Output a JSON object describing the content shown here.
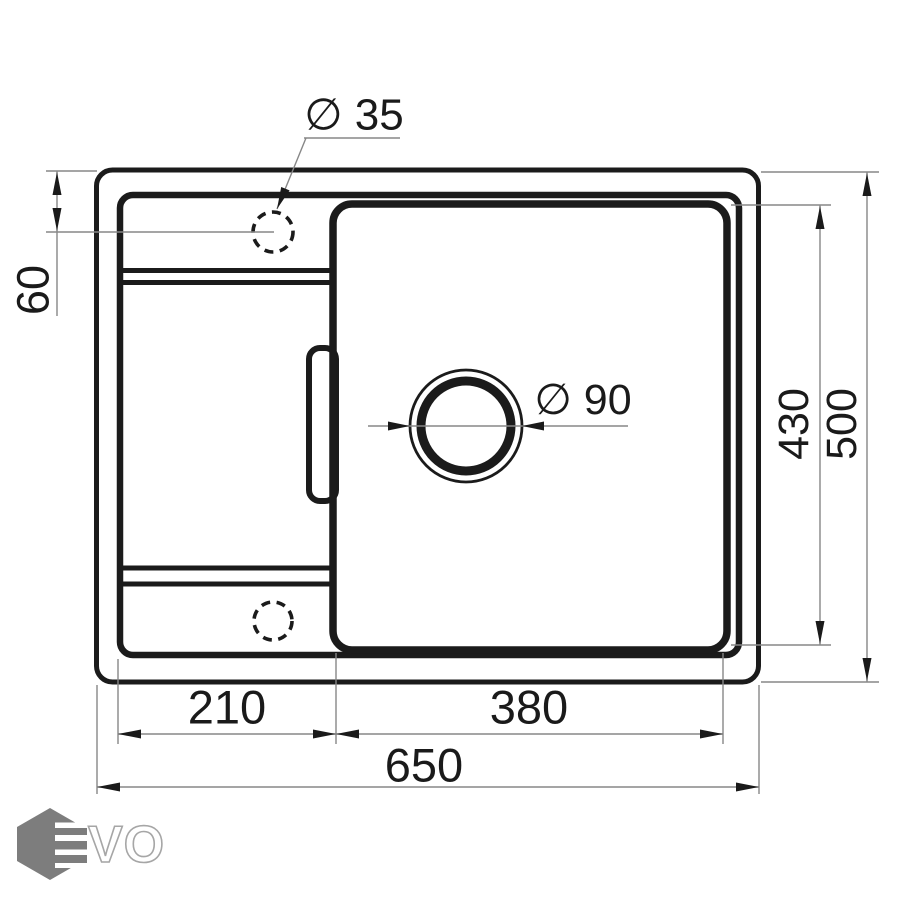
{
  "page": {
    "background": "#ffffff",
    "description": "Technical dimension drawing, top view of a rectangular kitchen sink with left drainboard, right bowl, faucet hole and drain hole"
  },
  "dimensions": {
    "overall_width": "650",
    "overall_depth": "500",
    "bowl_depth": "430",
    "bowl_width": "380",
    "drainboard_width": "210",
    "faucet_offset_from_edge": "60",
    "faucet_hole_diameter": "∅ 35",
    "drain_hole_diameter": "∅ 90"
  },
  "logo": {
    "brand": "EVO",
    "vo_text": "VO"
  },
  "colors": {
    "drawing_line": "#1b1b1b",
    "dimension_line": "#878787",
    "dimension_text": "#1a1a1a",
    "logo_hex": "#7d7d7d",
    "logo_letter_outline": "#a6a6a6",
    "background": "#ffffff"
  }
}
